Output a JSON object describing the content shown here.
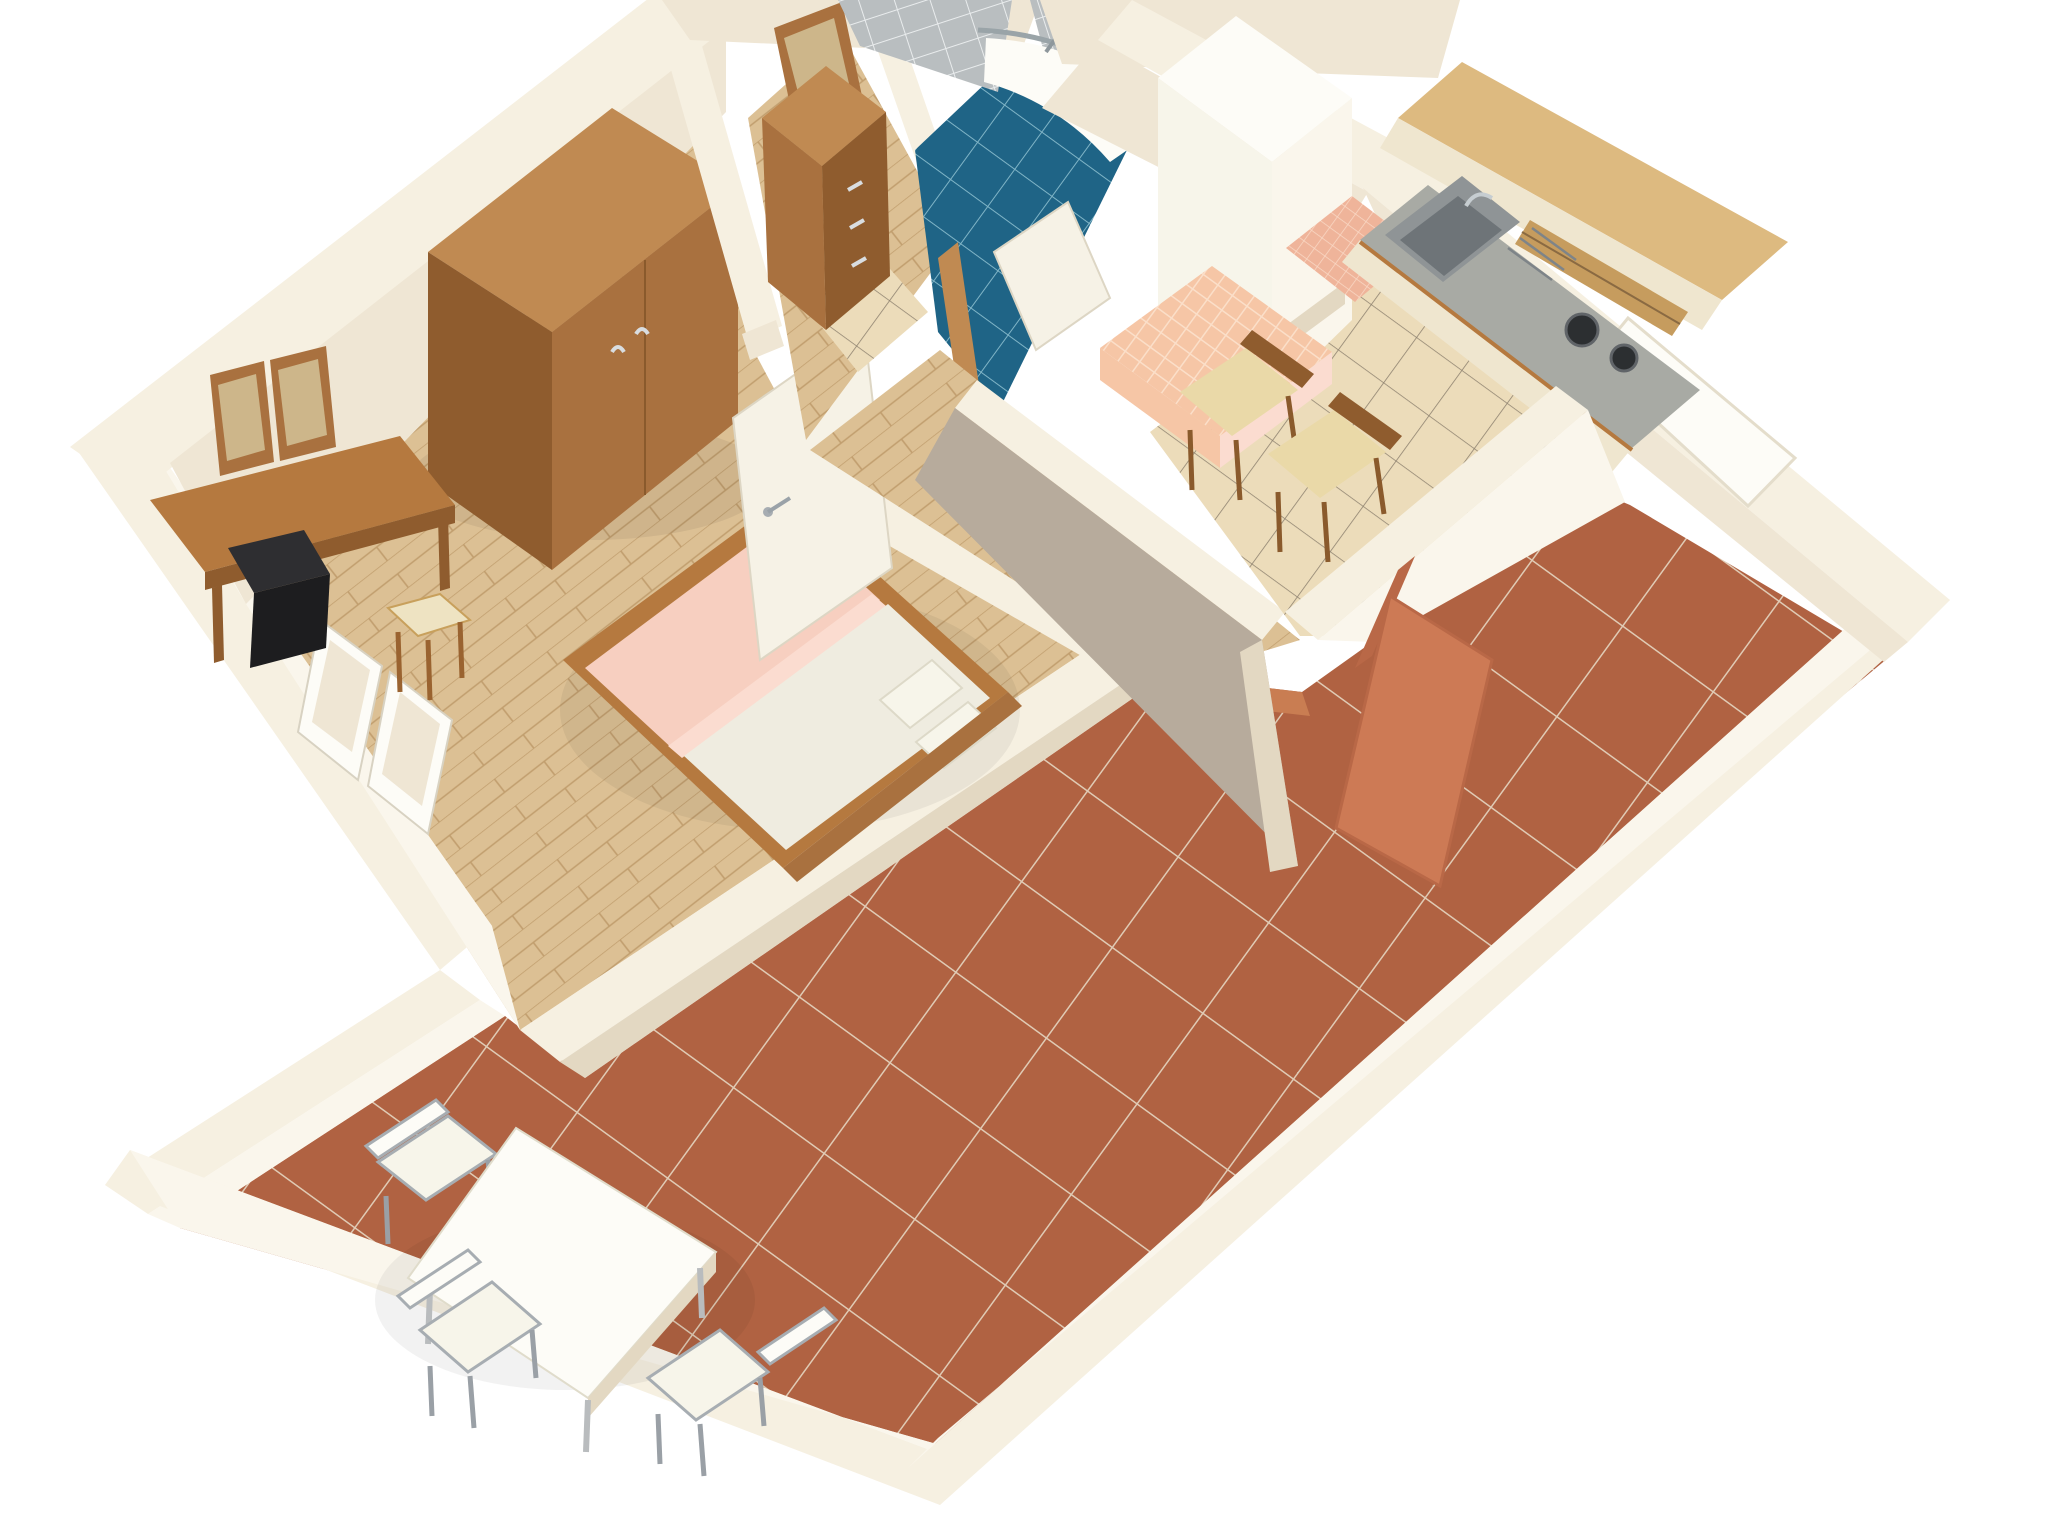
{
  "scene": {
    "kind": "3d-floor-plan-render",
    "view": "isometric overhead, apartment rotated 45 degrees, cut-away walls",
    "rooms": [
      {
        "name": "bedroom",
        "floor": "light wood parquet",
        "furniture": [
          "double bed with pink blanket, cream duvet and two pillows",
          "two-door wardrobe",
          "desk with two leaning mirrors",
          "black tv on desk",
          "stool with cream cushion",
          "open white interior door",
          "white balcony window frames"
        ]
      },
      {
        "name": "hallway",
        "floor": "wood parquet with beige tile threshold",
        "furniture": [
          "wooden dresser with drawers",
          "leaning wall mirror"
        ]
      },
      {
        "name": "bathroom",
        "floor": "dark blue ceramic tiles",
        "furniture": [
          "corner quarter-round shower tray with chrome glass frame",
          "grey wall tiles",
          "open cream door with wood frame"
        ]
      },
      {
        "name": "kitchen",
        "floor": "beige diagonal ceramic tiles",
        "furniture": [
          "beech upper cabinets with open shelves",
          "stainless sink with drainboard and faucet",
          "two-burner gas hob",
          "cream base cabinets",
          "white tall cabinet with shelf niche",
          "salmon tile backsplash",
          "dining table with peach checkered tablecloth",
          "two wooden chairs with cream seats",
          "terracotta door to terrace",
          "window niche to terrace"
        ]
      },
      {
        "name": "terrace",
        "floor": "terracotta diagonal tiles with light grout",
        "furniture": [
          "square white table",
          "three metal-frame chairs with white slat seats"
        ]
      }
    ]
  },
  "palette": {
    "bg": "#ffffff",
    "wallTop": "#f6f0e1",
    "wallFace": "#efe6d4",
    "wallBright": "#faf6ec",
    "wallShadow": "#e3d8c2",
    "wallGray": "#b7ab9c",
    "white": "#fdfcf7",
    "woodFloorBase": "#dcc094",
    "kitchenTileBase": "#ecdcba",
    "terracottaBase": "#b06242",
    "blueTileBase": "#1f6486",
    "grayTileBase": "#b9bec0",
    "clothBase": "#f6c6a6",
    "salmonBase": "#efb49a",
    "woodLight": "#c08a52",
    "woodMid": "#a9713f",
    "woodDark": "#8f5c2e",
    "woodDesk": "#b5793f",
    "counterGray": "#a8aaa4",
    "steelMid": "#8f9496",
    "steelDark": "#6e7478",
    "burner": "#2c2f31",
    "beechTop": "#ddba80",
    "beechShelf": "#c69c5e",
    "cabinetCream": "#efe6cf",
    "pink": "#f7cfc0",
    "pinkLight": "#fbdcd0",
    "duvet": "#efece0",
    "pillow": "#f7f5ea",
    "cushion": "#ead9a8",
    "stoolCushion": "#eee3c2",
    "metal": "#a7adb2",
    "tvBlack": "#1d1d1f",
    "tvTop": "#2e2e31",
    "doorLeaf": "#f6f2e6",
    "terracottaDoor": "#cd7a55",
    "terracottaDoorDark": "#b96847",
    "thresholdOrange": "#c97d52",
    "mirrorGlass": "#cdb68a"
  }
}
